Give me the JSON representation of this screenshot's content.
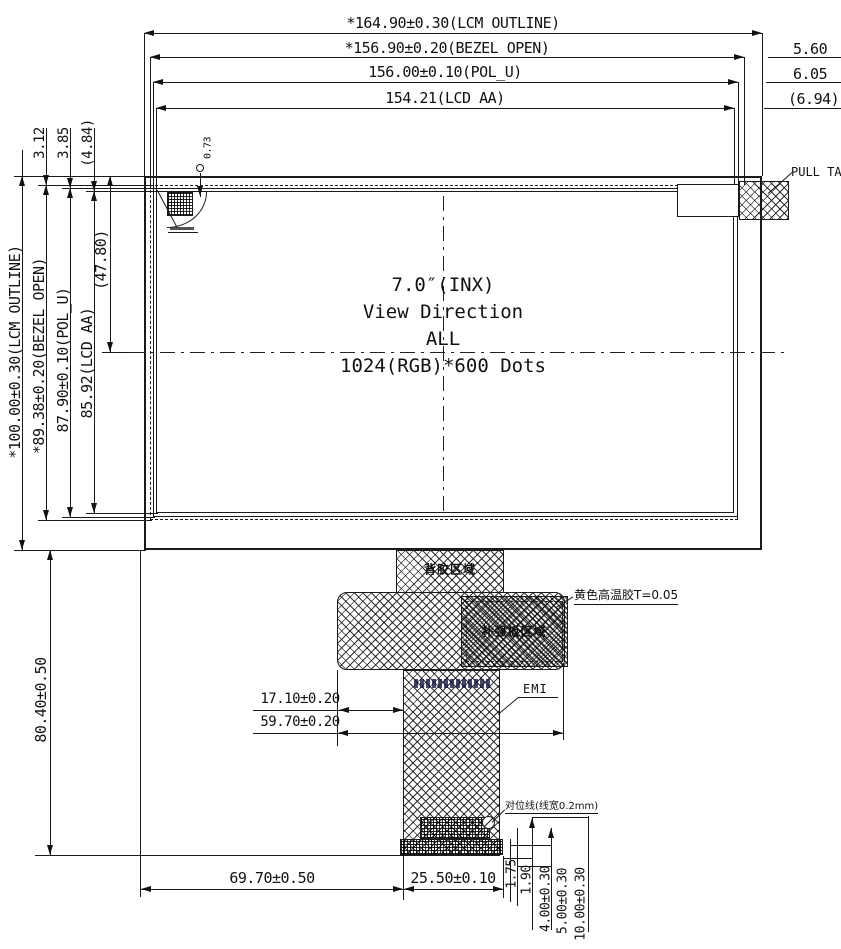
{
  "colors": {
    "line": "#1a1a1a",
    "background": "#ffffff"
  },
  "drawing": {
    "top_dims": [
      "*164.90±0.30(LCM OUTLINE)",
      "*156.90±0.20(BEZEL OPEN)",
      "156.00±0.10(POL_U)",
      "154.21(LCD AA)"
    ],
    "right_dims": [
      "5.60",
      "6.05",
      "(6.94)"
    ],
    "left_dims": [
      "*100.00±0.30(LCM OUTLINE)",
      "*89.38±0.20(BEZEL OPEN)",
      "87.90±0.10(POL_U)",
      "85.92(LCD AA)"
    ],
    "left_partial_dim": "(47.80)",
    "top_left_dims": [
      "3.12",
      "3.85",
      "(4.84)"
    ],
    "wire_dim": "0.73",
    "center": {
      "size": "7.0″(INX)",
      "view": "View Direction",
      "direction": "ALL",
      "resolution": "1024(RGB)*600 Dots"
    },
    "pull_tape_label": "PULL TAPE",
    "emi_label": "EMI",
    "yellow_tape_label": "黄色高温胶T=0.05",
    "align_label": "对位线(线宽0.2mm)",
    "fpc_region_top": "背胶区域",
    "fpc_region_stiffener": "补强板区域",
    "fpc_dims": [
      "17.10±0.20",
      "59.70±0.20"
    ],
    "bottom_left_dim": "80.40±0.50",
    "bottom_dims": [
      "69.70±0.50",
      "25.50±0.10"
    ],
    "bottom_small_dims": [
      "1.75",
      "1.90",
      "4.00±0.30",
      "5.00±0.30",
      "10.00±0.30"
    ]
  }
}
